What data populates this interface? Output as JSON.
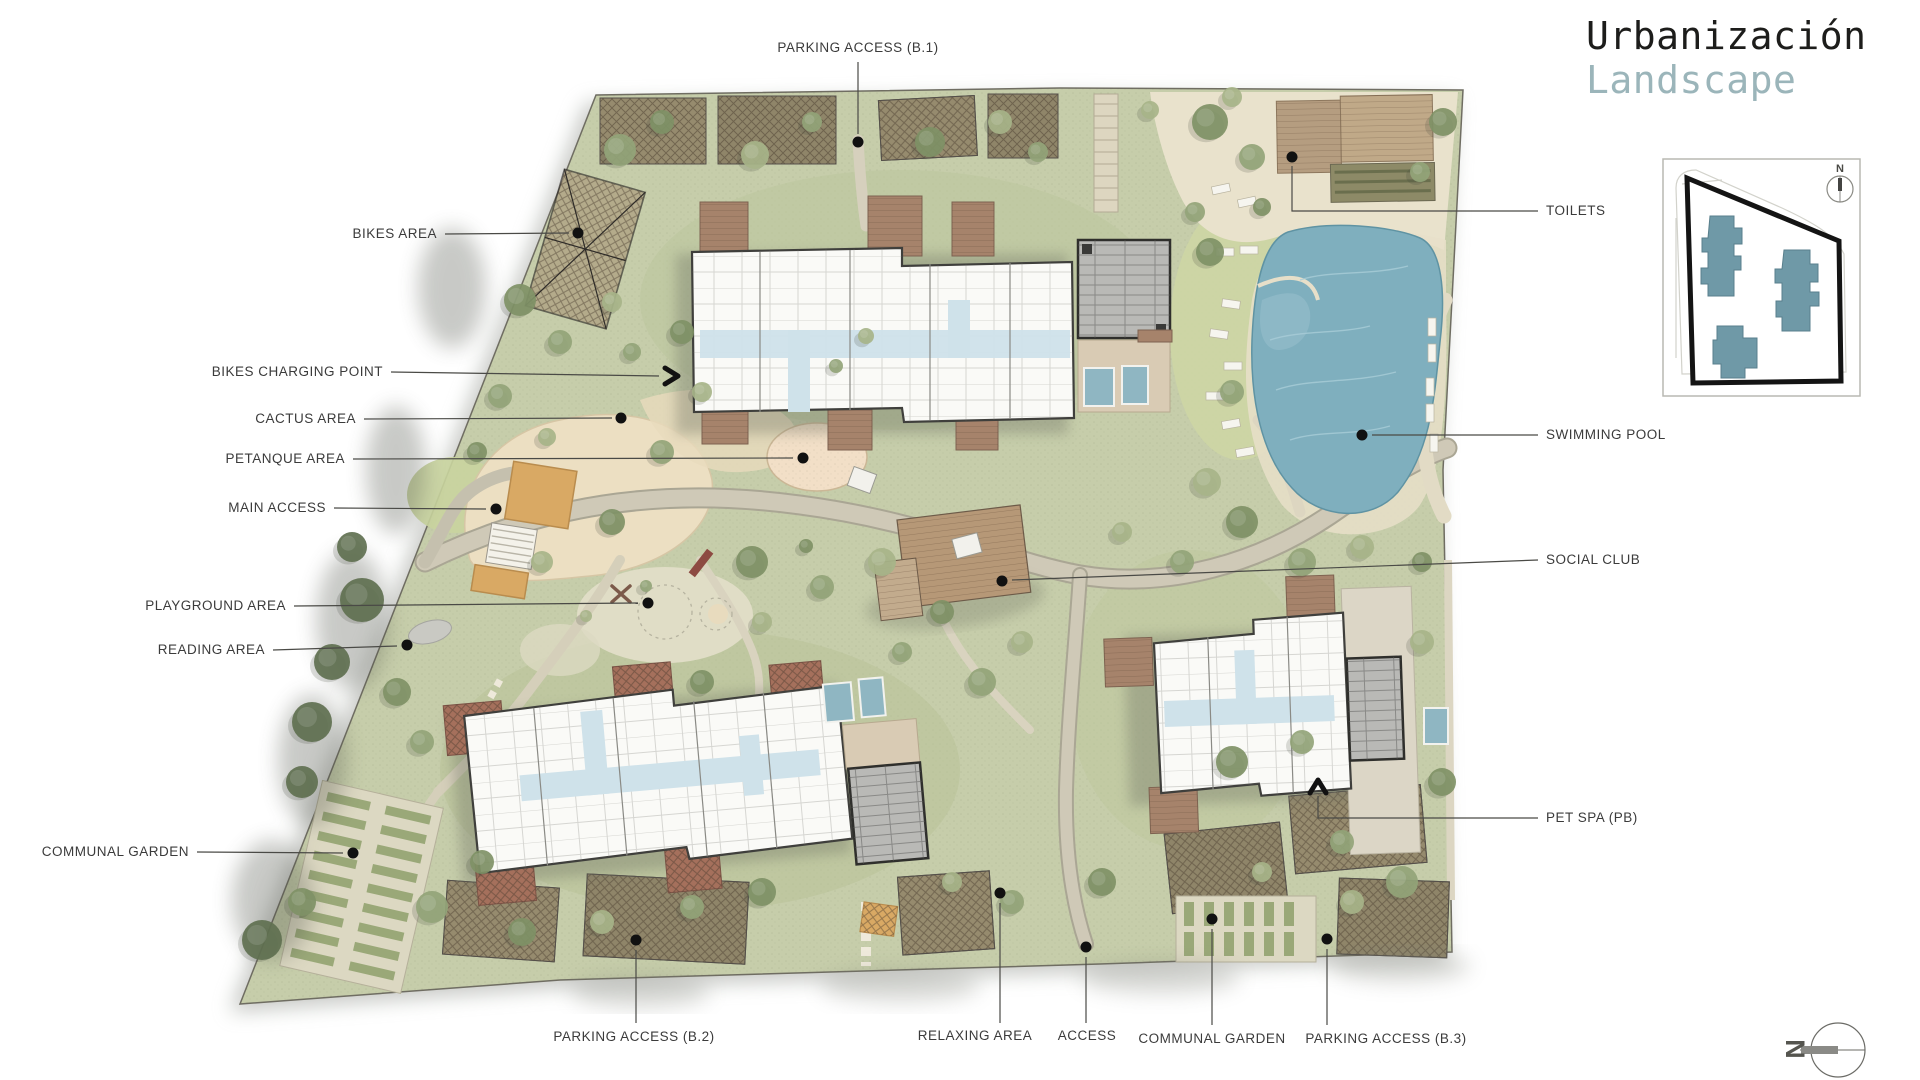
{
  "header": {
    "title_line1": "Urbanización",
    "title_line2": "Landscape"
  },
  "key_map": {
    "north_label": "N"
  },
  "compass": {
    "north_letter": "N"
  },
  "palette": {
    "ground": "#c6cdaa",
    "pool": "#7fafbe",
    "deck_wood": "#a6836b",
    "roof_gray": "#b9b9b6",
    "sand": "#ecdfc2",
    "title_dark": "#1d1d1b",
    "title_teal": "#9bb5ba",
    "label_text": "#3b3b3b",
    "keymap_building": "#6f99a7"
  },
  "callouts": [
    {
      "id": "parking-access-b1",
      "label": "PARKING ACCESS (B.1)",
      "x": 858,
      "y": 48,
      "align": "center",
      "leader": [
        [
          858,
          62
        ],
        [
          858,
          134
        ]
      ],
      "end": "dot",
      "ex": 858,
      "ey": 142
    },
    {
      "id": "toilets",
      "label": "TOILETS",
      "x": 1546,
      "y": 211,
      "align": "left",
      "leader": [
        [
          1538,
          211
        ],
        [
          1292,
          211
        ],
        [
          1292,
          166
        ]
      ],
      "end": "dot",
      "ex": 1292,
      "ey": 157
    },
    {
      "id": "swimming-pool",
      "label": "SWIMMING POOL",
      "x": 1546,
      "y": 435,
      "align": "left",
      "leader": [
        [
          1538,
          435
        ],
        [
          1372,
          435
        ]
      ],
      "end": "dot",
      "ex": 1362,
      "ey": 435
    },
    {
      "id": "social-club",
      "label": "SOCIAL CLUB",
      "x": 1546,
      "y": 560,
      "align": "left",
      "leader": [
        [
          1538,
          560
        ],
        [
          1012,
          580
        ]
      ],
      "end": "dot",
      "ex": 1002,
      "ey": 581
    },
    {
      "id": "pet-spa",
      "label": "PET SPA (PB)",
      "x": 1546,
      "y": 818,
      "align": "left",
      "leader": [
        [
          1538,
          818
        ],
        [
          1318,
          818
        ],
        [
          1318,
          796
        ]
      ],
      "end": "chevron-up",
      "ex": 1318,
      "ey": 782
    },
    {
      "id": "bikes-area",
      "label": "BIKES AREA",
      "x": 437,
      "y": 234,
      "align": "right",
      "leader": [
        [
          445,
          234
        ],
        [
          569,
          233
        ]
      ],
      "end": "dot",
      "ex": 578,
      "ey": 233
    },
    {
      "id": "bikes-charging-point",
      "label": "BIKES CHARGING POINT",
      "x": 383,
      "y": 372,
      "align": "right",
      "leader": [
        [
          391,
          372
        ],
        [
          659,
          376
        ]
      ],
      "end": "chevron-right",
      "ex": 676,
      "ey": 376
    },
    {
      "id": "cactus-area",
      "label": "CACTUS AREA",
      "x": 356,
      "y": 419,
      "align": "right",
      "leader": [
        [
          364,
          419
        ],
        [
          612,
          418
        ]
      ],
      "end": "dot",
      "ex": 621,
      "ey": 418
    },
    {
      "id": "petanque-area",
      "label": "PETANQUE AREA",
      "x": 345,
      "y": 459,
      "align": "right",
      "leader": [
        [
          353,
          459
        ],
        [
          793,
          458
        ]
      ],
      "end": "dot",
      "ex": 803,
      "ey": 458
    },
    {
      "id": "main-access",
      "label": "MAIN ACCESS",
      "x": 326,
      "y": 508,
      "align": "right",
      "leader": [
        [
          334,
          508
        ],
        [
          486,
          509
        ]
      ],
      "end": "dot",
      "ex": 496,
      "ey": 509
    },
    {
      "id": "playground-area",
      "label": "PLAYGROUND AREA",
      "x": 286,
      "y": 606,
      "align": "right",
      "leader": [
        [
          294,
          606
        ],
        [
          638,
          603
        ]
      ],
      "end": "dot",
      "ex": 648,
      "ey": 603
    },
    {
      "id": "reading-area",
      "label": "READING AREA",
      "x": 265,
      "y": 650,
      "align": "right",
      "leader": [
        [
          273,
          650
        ],
        [
          397,
          646
        ]
      ],
      "end": "dot",
      "ex": 407,
      "ey": 645
    },
    {
      "id": "communal-garden-left",
      "label": "COMMUNAL GARDEN",
      "x": 189,
      "y": 852,
      "align": "right",
      "leader": [
        [
          197,
          852
        ],
        [
          343,
          853
        ]
      ],
      "end": "dot",
      "ex": 353,
      "ey": 853
    },
    {
      "id": "parking-access-b2",
      "label": "PARKING ACCESS (B.2)",
      "x": 634,
      "y": 1037,
      "align": "center",
      "leader": [
        [
          636,
          1023
        ],
        [
          636,
          950
        ]
      ],
      "end": "dot",
      "ex": 636,
      "ey": 940
    },
    {
      "id": "relaxing-area",
      "label": "RELAXING AREA",
      "x": 975,
      "y": 1036,
      "align": "center",
      "leader": [
        [
          1000,
          1023
        ],
        [
          1000,
          903
        ]
      ],
      "end": "dot",
      "ex": 1000,
      "ey": 893
    },
    {
      "id": "access",
      "label": "ACCESS",
      "x": 1087,
      "y": 1036,
      "align": "center",
      "leader": [
        [
          1086,
          1023
        ],
        [
          1086,
          957
        ]
      ],
      "end": "dot",
      "ex": 1086,
      "ey": 947
    },
    {
      "id": "communal-garden-bottom",
      "label": "COMMUNAL GARDEN",
      "x": 1212,
      "y": 1039,
      "align": "center",
      "leader": [
        [
          1212,
          1025
        ],
        [
          1212,
          929
        ]
      ],
      "end": "dot",
      "ex": 1212,
      "ey": 919
    },
    {
      "id": "parking-access-b3",
      "label": "PARKING ACCESS (B.3)",
      "x": 1386,
      "y": 1039,
      "align": "center",
      "leader": [
        [
          1327,
          1025
        ],
        [
          1327,
          949
        ]
      ],
      "end": "dot",
      "ex": 1327,
      "ey": 939
    }
  ]
}
